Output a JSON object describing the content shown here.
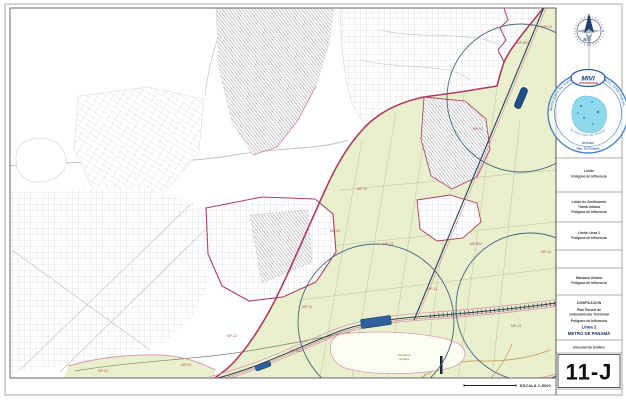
{
  "document": {
    "sheet_number": "11-J",
    "type_label": "Documento Gráfico",
    "scale_label": "ESCALA  1:5000"
  },
  "title_block": {
    "heading": "ZONIFICACIÓN",
    "line2": "Plan Parcial de",
    "line3": "Ordenamiento Territorial",
    "line4": "Polígono de Influencia",
    "line5": "Línea 2",
    "line6": "METRO DE PANAMÁ"
  },
  "legend": {
    "items": [
      {
        "lines": [
          "Límite",
          "Polígono de Influencia"
        ]
      },
      {
        "lines": [
          "Límite de Zonificación",
          "Trama Urbana",
          "Polígono de Influencia"
        ]
      },
      {
        "lines": [
          "Límite Línea 2",
          "Polígono de Influencia"
        ]
      },
      {
        "lines": [
          "Manzana Urbana",
          "Polígono de Influencia"
        ]
      }
    ]
  },
  "stamp": {
    "logo_text": "MIVI",
    "ring_text": "MINISTERIO DE VIVIENDA Y ORDENAMIENTO TERRITORIAL",
    "arc_text": "Es Fiel Copia del Original",
    "office_text": "OFICINA",
    "country_text": "Rep. De Panamá"
  },
  "compass": {
    "north_label": "N"
  },
  "map": {
    "zone_labels": [
      {
        "text": "MP-02",
        "x": 103,
        "y": 372
      },
      {
        "text": "MP-03",
        "x": 186,
        "y": 366
      },
      {
        "text": "MP-12",
        "x": 232,
        "y": 337
      },
      {
        "text": "MP-B02",
        "x": 296,
        "y": 352
      },
      {
        "text": "MP-12",
        "x": 307,
        "y": 308
      },
      {
        "text": "MP-12",
        "x": 362,
        "y": 190
      },
      {
        "text": "MP-02",
        "x": 335,
        "y": 232
      },
      {
        "text": "MP-13",
        "x": 388,
        "y": 245
      },
      {
        "text": "MP-13",
        "x": 432,
        "y": 290
      },
      {
        "text": "MP-13",
        "x": 516,
        "y": 327
      },
      {
        "text": "MP-13",
        "x": 546,
        "y": 253
      },
      {
        "text": "MP-B02",
        "x": 476,
        "y": 245
      },
      {
        "text": "MP-02",
        "x": 478,
        "y": 130
      },
      {
        "text": "MP-B03",
        "x": 523,
        "y": 44
      },
      {
        "text": "MP-03",
        "x": 547,
        "y": 28
      }
    ],
    "note_label": {
      "line1": "Condición",
      "line2": "Jurídica",
      "x": 404,
      "y1": 356,
      "y2": 360
    }
  },
  "palette": {
    "zone_green": "#eaf0cd",
    "boundary_magenta": "#b13b63",
    "boundary_pink": "#d898ae",
    "metro_navy": "#26415e",
    "station_blue": "#2e5f9e",
    "influence_circle": "#47637c",
    "street_gray": "#cdcdcd",
    "stamp_blue": "#4a86c8",
    "stamp_cyan": "#8ed9ec"
  }
}
